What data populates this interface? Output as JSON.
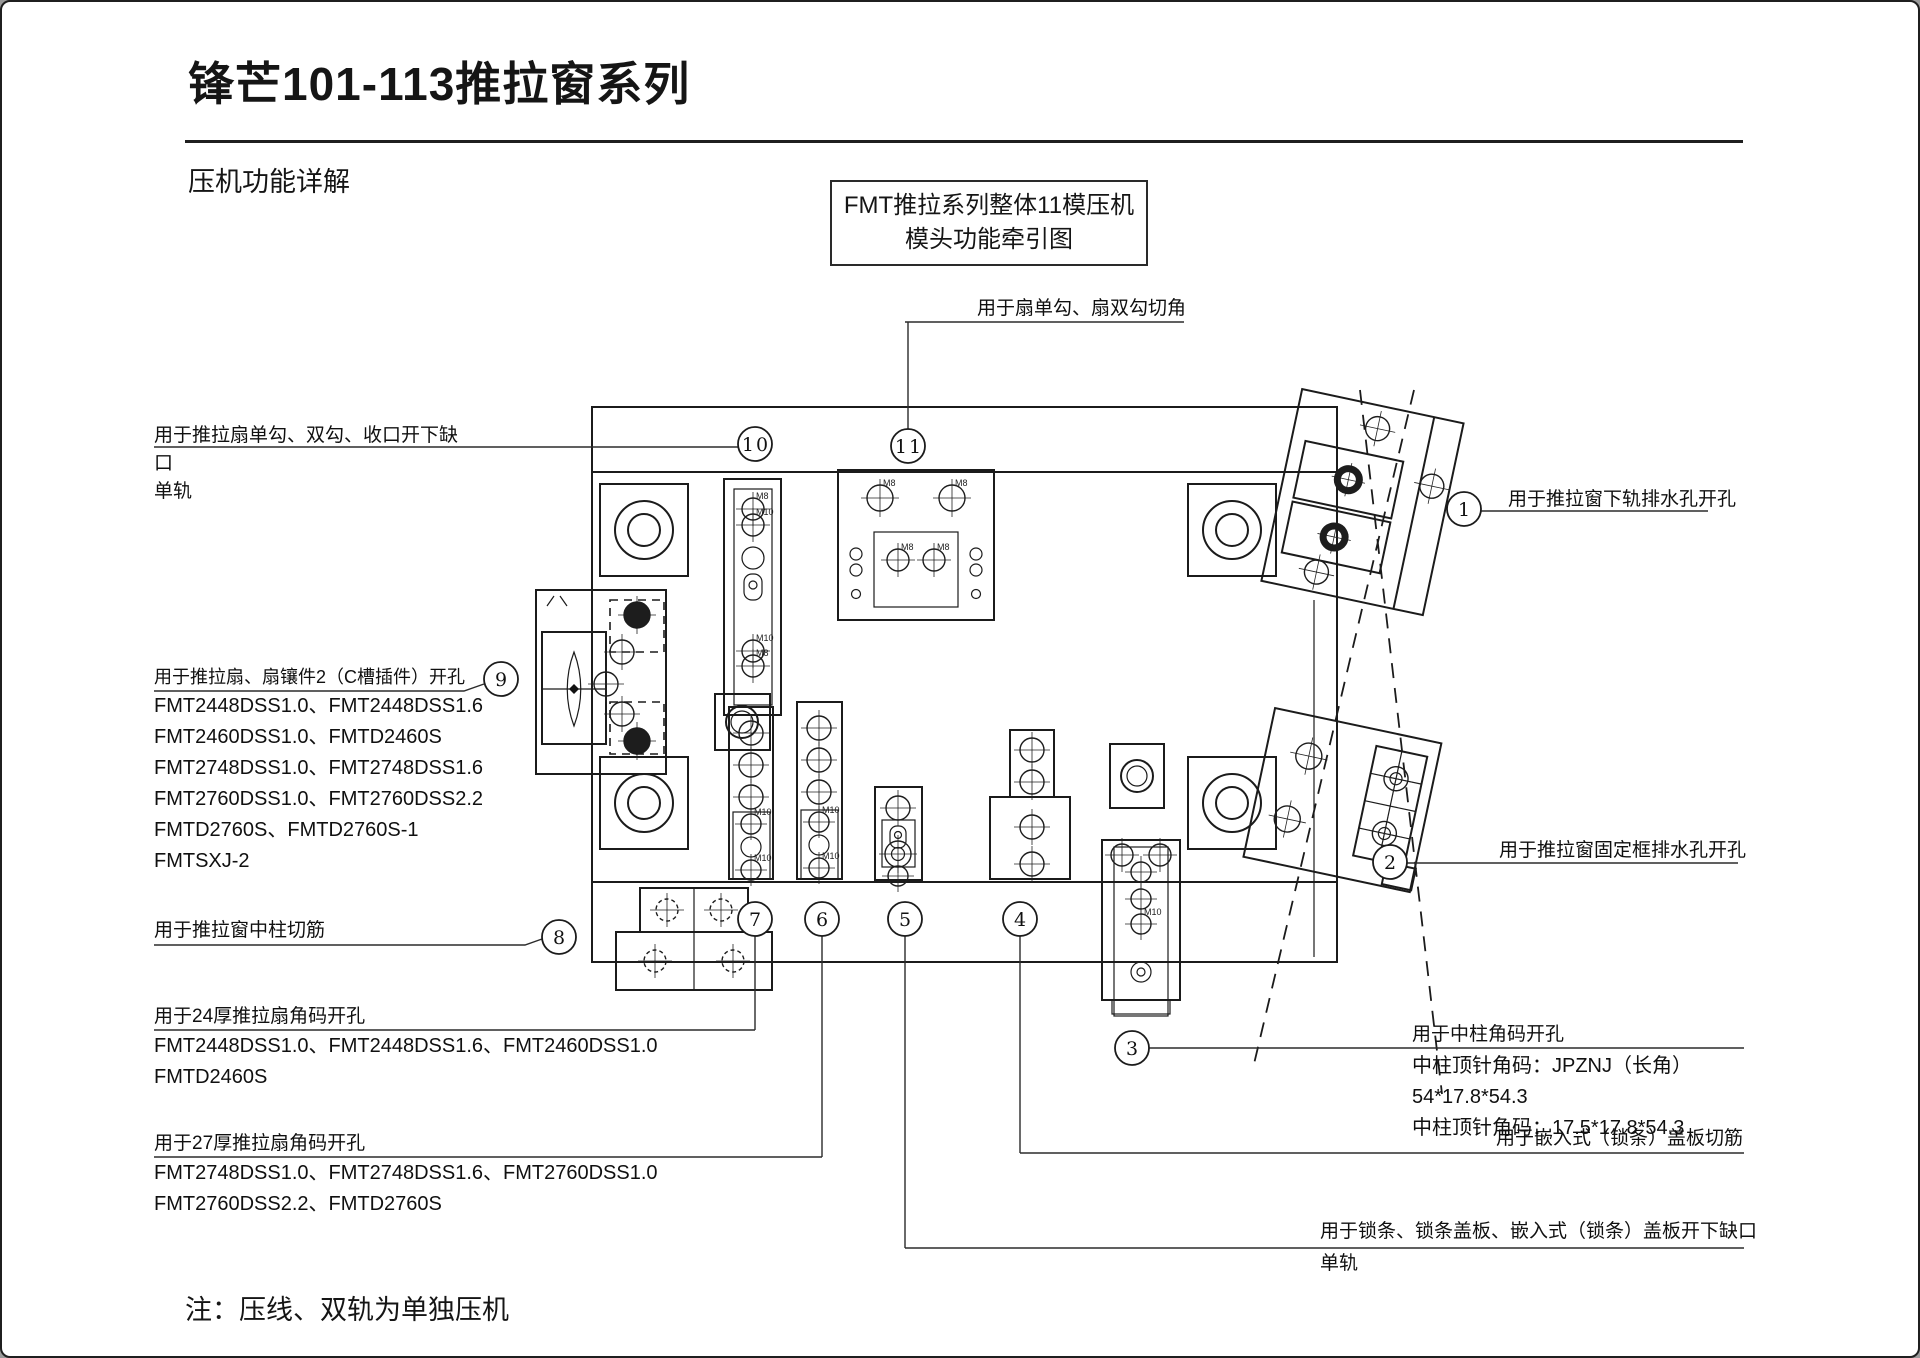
{
  "header": {
    "title": "锋芒101-113推拉窗系列",
    "subtitle": "压机功能详解"
  },
  "diagram_box": {
    "line1": "FMT推拉系列整体11模压机",
    "line2": "模头功能牵引图"
  },
  "note": "注：压线、双轨为单独压机",
  "balloons": [
    "1",
    "2",
    "3",
    "4",
    "5",
    "6",
    "7",
    "8",
    "9",
    "10",
    "11"
  ],
  "labels": {
    "fan_corner_cut": "用于扇单勾、扇双勾切角",
    "sash_notch_line1": "用于推拉扇单勾、双勾、收口开下缺",
    "sash_notch_line2": "口",
    "sash_notch_line3": "单轨",
    "lower_rail_drain": "用于推拉窗下轨排水孔开孔",
    "fixed_frame_drain": "用于推拉窗固定框排水孔开孔",
    "sash_insert_title": "用于推拉扇、扇镶件2（C槽插件）开孔",
    "sash_insert_models": [
      "FMT2448DSS1.0、FMT2448DSS1.6",
      "FMT2460DSS1.0、FMTD2460S",
      "FMT2748DSS1.0、FMT2748DSS1.6",
      "FMT2760DSS1.0、FMT2760DSS2.2",
      "FMTD2760S、FMTD2760S-1",
      "FMTSXJ-2"
    ],
    "mullion_rib_cut": "用于推拉窗中柱切筋",
    "corner24_title": "用于24厚推拉扇角码开孔",
    "corner24_models": [
      "FMT2448DSS1.0、FMT2448DSS1.6、FMT2460DSS1.0",
      "FMTD2460S"
    ],
    "corner27_title": "用于27厚推拉扇角码开孔",
    "corner27_models": [
      "FMT2748DSS1.0、FMT2748DSS1.6、FMT2760DSS1.0",
      "FMT2760DSS2.2、FMTD2760S"
    ],
    "mullion_corner_title": "用于中柱角码开孔",
    "mullion_corner_lines": [
      "中柱顶针角码：JPZNJ（长角）",
      "54*17.8*54.3",
      "中柱顶针角码：17.5*17.8*54.3"
    ],
    "cover_rib_cut": "用于嵌入式（锁条）盖板切筋",
    "lock_strip_line1": "用于锁条、锁条盖板、嵌入式（锁条）盖板开下缺口",
    "lock_strip_line2": "单轨"
  },
  "drawing": {
    "hole_labels": {
      "m8": "M8",
      "m10": "M10"
    }
  }
}
